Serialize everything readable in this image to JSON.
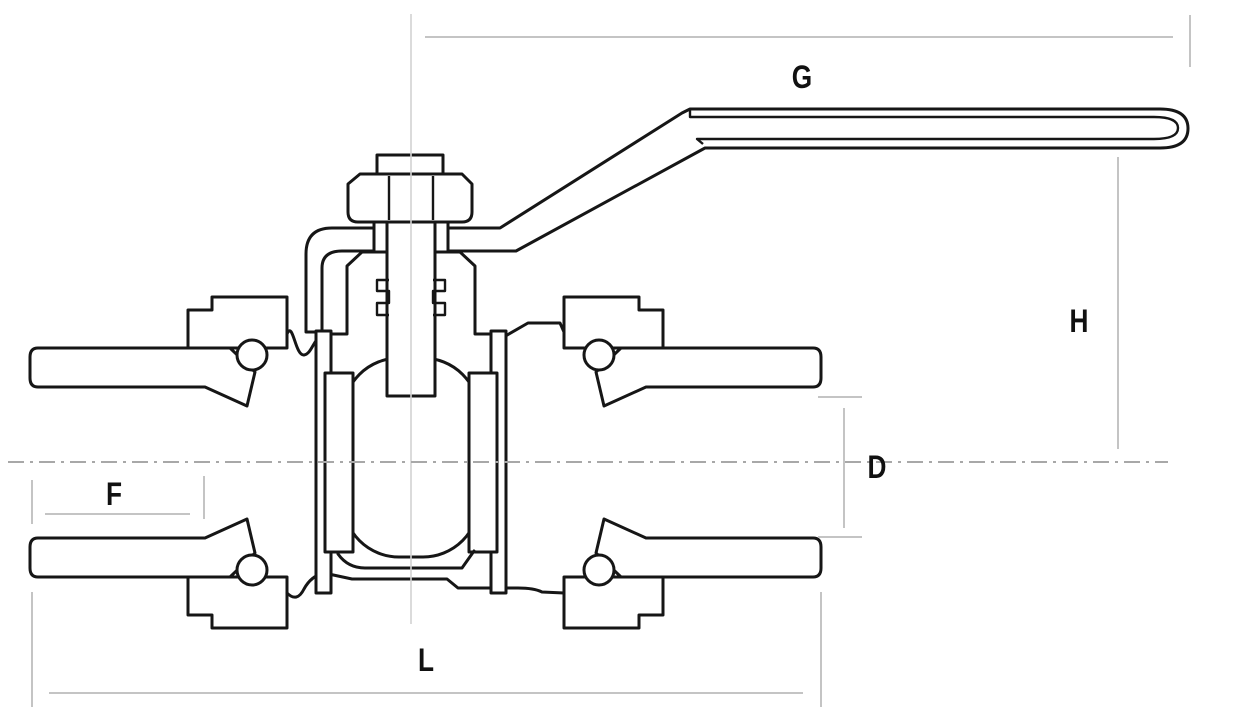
{
  "diagram": {
    "drawing_name": "ball-valve-cross-section",
    "dimension_labels": [
      {
        "id": "g",
        "text": "G",
        "x": 802,
        "y": 88
      },
      {
        "id": "h",
        "text": "H",
        "x": 1079,
        "y": 332
      },
      {
        "id": "d",
        "text": "D",
        "x": 877,
        "y": 478
      },
      {
        "id": "f",
        "text": "F",
        "x": 114,
        "y": 505
      },
      {
        "id": "l",
        "text": "L",
        "x": 426,
        "y": 671
      }
    ],
    "colors": {
      "drawing_line": "#161616",
      "dimension_line": "#c4c4c4",
      "centerline": "#a8a8a8",
      "label_text": "#111111",
      "background": "#ffffff"
    }
  }
}
